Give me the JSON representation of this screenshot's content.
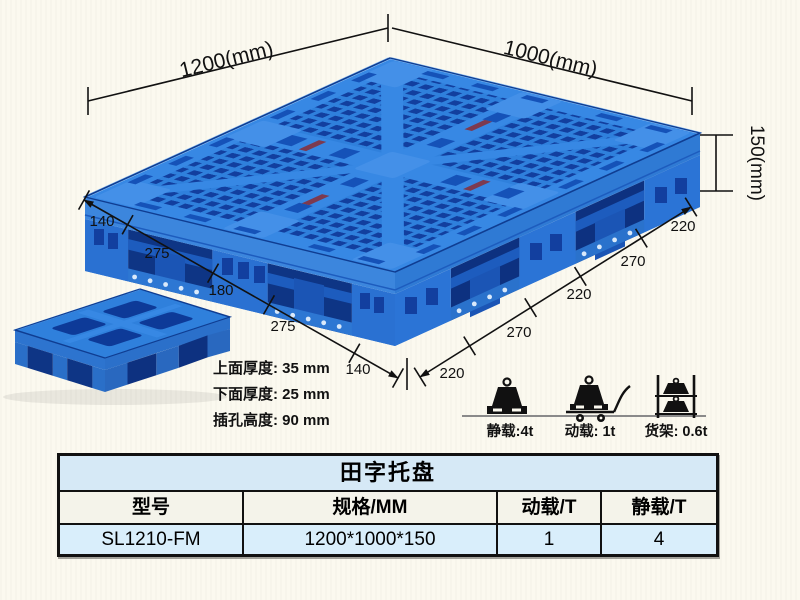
{
  "illustration": {
    "dim_top_left": "1200(mm)",
    "dim_top_right": "1000(mm)",
    "dim_height": "150(mm)",
    "left_chain": [
      "140",
      "275",
      "180",
      "275",
      "140"
    ],
    "right_chain": [
      "220",
      "270",
      "220",
      "270",
      "220"
    ],
    "thickness_notes": [
      "上面厚度: 35 mm",
      "下面厚度: 25 mm",
      "插孔高度: 90 mm"
    ],
    "load_icons": [
      {
        "icon": "static-load-weight-icon",
        "label": "静载:4t"
      },
      {
        "icon": "dynamic-load-trolley-icon",
        "label": "动载: 1t"
      },
      {
        "icon": "rack-load-shelf-icon",
        "label": "货架: 0.6t"
      }
    ],
    "colors": {
      "pallet_blue": "#2f80dc",
      "pallet_band": "#3788e4",
      "pallet_dark_holes": "#123f9f",
      "pallet_side_gap": "#0e3585",
      "dim_line": "#111111",
      "background": "#fbf9ef"
    }
  },
  "table": {
    "title": "田字托盘",
    "headers": [
      "型号",
      "规格/MM",
      "动载/T",
      "静载/T"
    ],
    "rows": [
      [
        "SL1210-FM",
        "1200*1000*150",
        "1",
        "4"
      ]
    ],
    "colors": {
      "title_bg": "#d6e9f6",
      "header_bg": "#f4f3ea",
      "row_bg": "#d9eefb"
    }
  }
}
